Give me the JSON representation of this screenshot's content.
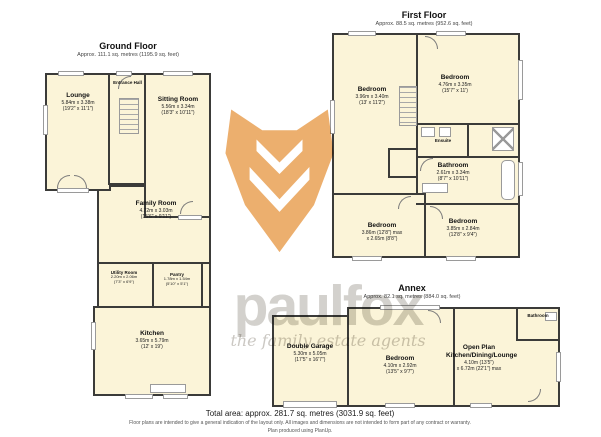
{
  "titles": {
    "ground": {
      "name": "Ground Floor",
      "area": "Approx. 111.1 sq. metres (1195.9 sq. feet)"
    },
    "first": {
      "name": "First Floor",
      "area": "Approx. 88.5 sq. metres (952.6 sq. feet)"
    },
    "annex": {
      "name": "Annex",
      "area": "Approx. 82.1 sq. metres (884.0 sq. feet)"
    }
  },
  "rooms": {
    "lounge": {
      "name": "Lounge",
      "metric": "5.84m x 3.38m",
      "imperial": "(19'2\" x 11'1\")"
    },
    "entrance_hall": {
      "name": "Entrance Hall"
    },
    "sitting": {
      "name": "Sitting Room",
      "metric": "5.56m x 3.34m",
      "imperial": "(18'3\" x 10'11\")"
    },
    "family": {
      "name": "Family Room",
      "metric": "4.72m x 3.03m",
      "imperial": "(15'6\" x 9'11\")"
    },
    "utility": {
      "name": "Utility Room",
      "metric": "2.20m x 2.06m",
      "imperial": "(7'3\" x 6'9\")"
    },
    "pantry": {
      "name": "Pantry",
      "metric": "1.78m x 1.54m",
      "imperial": "(5'10\" x 5'1\")"
    },
    "kitchen": {
      "name": "Kitchen",
      "metric": "3.65m x 5.79m",
      "imperial": "(12' x 19')"
    },
    "bed1": {
      "name": "Bedroom",
      "metric": "3.96m x 3.40m",
      "imperial": "(13' x 11'2\")"
    },
    "bed2": {
      "name": "Bedroom",
      "metric": "4.76m x 3.35m",
      "imperial": "(15'7\" x 11')"
    },
    "ensuite": {
      "name": "Ensuite"
    },
    "bathroom1": {
      "name": "Bathroom",
      "metric": "2.61m x 3.34m",
      "imperial": "(8'7\" x 10'11\")"
    },
    "bed3": {
      "name": "Bedroom",
      "metric": "3.86m (12'8\") max",
      "imperial": "x 2.65m (8'8\")"
    },
    "bed4": {
      "name": "Bedroom",
      "metric": "3.85m x 2.84m",
      "imperial": "(12'8\" x 9'4\")"
    },
    "garage": {
      "name": "Double Garage",
      "metric": "5.30m x 5.05m",
      "imperial": "(17'5\" x 16'7\")"
    },
    "bed5": {
      "name": "Bedroom",
      "metric": "4.10m x 2.92m",
      "imperial": "(13'5\" x 9'7\")"
    },
    "openplan": {
      "name": "Open Plan Kitchen/Dining/Lounge",
      "metric": "4.10m (13'5\")",
      "imperial": "x 6.72m (22'1\") max"
    },
    "bathroom2": {
      "name": "Bathroom"
    }
  },
  "watermark": {
    "brand": "paulfox",
    "tagline": "the family estate agents"
  },
  "footer": {
    "total": "Total area: approx. 281.7 sq. metres (3031.9 sq. feet)",
    "disclaimer": "Floor plans are intended to give a general indication of the layout only. All images and dimensions are not intended to form part of any contract or warranty.",
    "produced": "Plan produced using PlanUp."
  }
}
